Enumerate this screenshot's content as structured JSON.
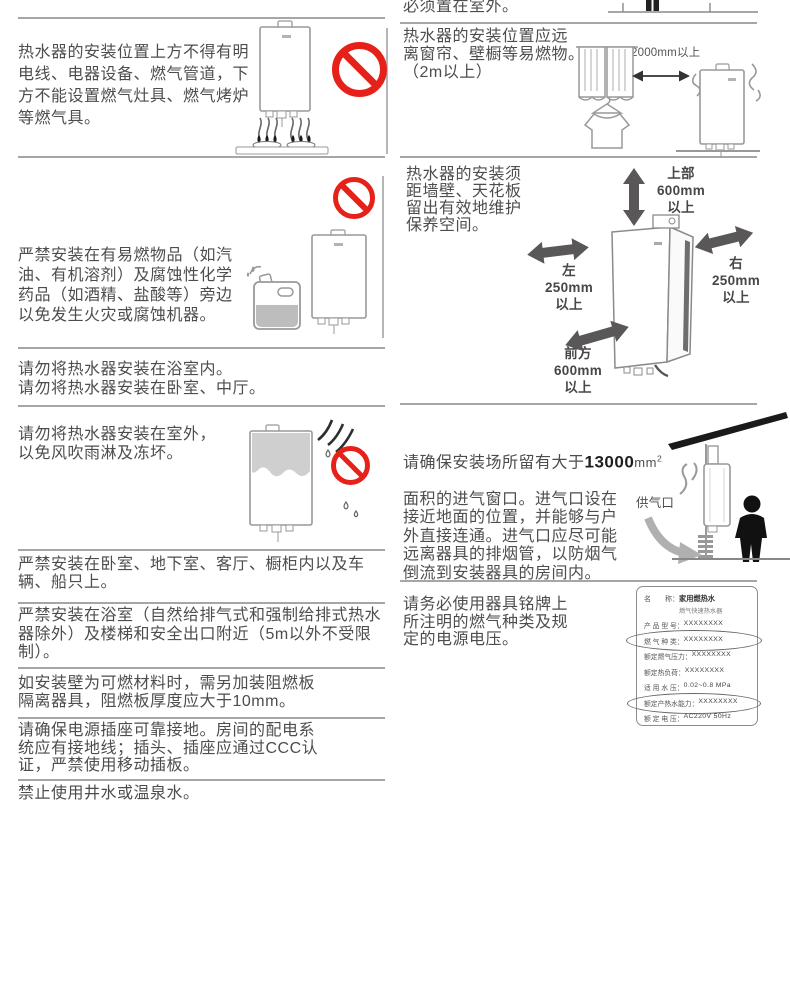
{
  "palette": {
    "prohibition_red": "#e6211a",
    "arrow_gray": "#595757",
    "line_gray": "#a6a6a6",
    "text_gray": "#4d4d4d"
  },
  "left": {
    "s1": "热水器的安装位置上方不得有明\n电线、电器设备、燃气管道，下\n方不能设置燃气灶具、燃气烤炉\n等燃气具。",
    "s2": "严禁安装在有易燃物品（如汽\n油、有机溶剂）及腐蚀性化学\n药品（如酒精、盐酸等）旁边\n以免发生火灾或腐蚀机器。",
    "s3": "请勿将热水器安装在浴室内。\n请勿将热水器安装在卧室、中厅。",
    "s4": "请勿将热水器安装在室外，\n以免风吹雨淋及冻坏。",
    "s5": "严禁安装在卧室、地下室、客厅、橱柜内以及车\n辆、船只上。",
    "s6": "严禁安装在浴室（自然给排气式和强制给排式热水\n器除外）及楼梯和安全出口附近（5m以外不受限\n制）。",
    "s7": "如安装壁为可燃材料时，需另加装阻燃板\n隔离器具，阻燃板厚度应大于10mm。",
    "s8": "请确保电源插座可靠接地。房间的配电系\n统应有接地线；插头、插座应通过CCC认\n证，严禁使用移动插板。",
    "s9": "禁止使用井水或温泉水。"
  },
  "right": {
    "s0": "必须置在室外。",
    "s1": "热水器的安装位置应远\n离窗帘、壁橱等易燃物。\n（2m以上）",
    "s1_dim": "2000mm以上",
    "s2": "热水器的安装须\n距墙壁、天花板\n留出有效地维护\n保养空间。",
    "dim_top": "上部\n600mm\n以上",
    "dim_left": "左\n250mm\n以上",
    "dim_right": "右\n250mm\n以上",
    "dim_front": "前方\n600mm\n以上",
    "s3_lead": "请确保安装场所留有大于",
    "s3_num": "13000",
    "s3_unit": "mm",
    "s3_sup": "2",
    "s3_rest": "面积的进气窗口。进气口设在\n接近地面的位置，并能够与户\n外直接连通。进气口应尽可能\n远离器具的排烟管，以防烟气\n倒流到安装器具的房间内。",
    "s3_label": "供气口",
    "s4": "请务必使用器具铭牌上\n所注明的燃气种类及规\n定的电源电压。",
    "nameplate": {
      "name_label": "名　　称：",
      "name_value": "家用燃热水",
      "name_value2": "燃气快速热水器",
      "rows": [
        {
          "label": "产 品 型 号：",
          "value": "XXXXXXXX"
        },
        {
          "label": "燃 气 种 类：",
          "value": "XXXXXXXX"
        },
        {
          "label": "额定燃气压力：",
          "value": "XXXXXXXX"
        },
        {
          "label": "额定热负荷：",
          "value": "XXXXXXXX"
        },
        {
          "label": "适 用 水 压：",
          "value": "0.02~0.8 MPa"
        },
        {
          "label": "额定产热水能力：",
          "value": "XXXXXXXX"
        },
        {
          "label": "额 定 电 压：",
          "value": "AC220V 50Hz"
        }
      ]
    }
  }
}
